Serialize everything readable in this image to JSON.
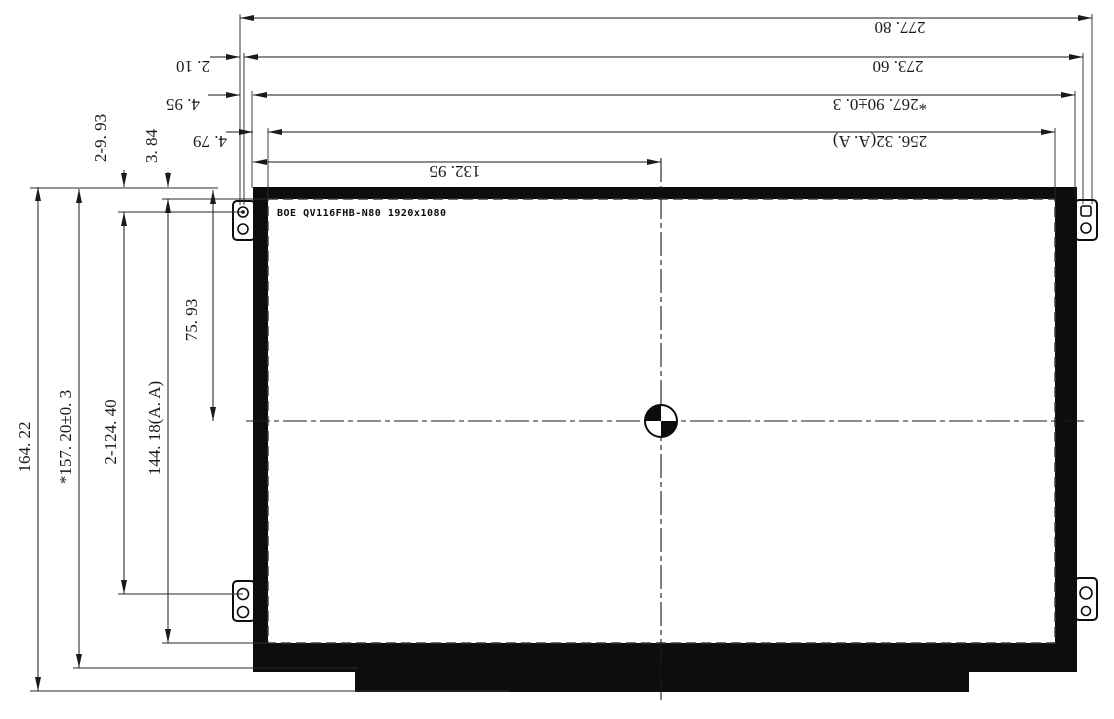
{
  "drawing": {
    "panel_label": "BOE QV116FHB-N80 1920x1080",
    "dims_horizontal": {
      "overall": "277. 80",
      "mounting": "273. 60",
      "side_gap": "2. 10",
      "outline": "*267. 90±0. 3",
      "edge_left": "4. 95",
      "active_area": "256. 32(A. A)",
      "aa_edge_left": "4. 79",
      "half_width": "132. 95"
    },
    "dims_vertical": {
      "overall": "164. 22",
      "outline": "*157. 20±0. 3",
      "hole_pitch": "2-124. 40",
      "active_area": "144. 18(A. A)",
      "half_height": "75. 93",
      "hole_offset": "2-9. 93",
      "edge_top": "3. 84"
    },
    "colors": {
      "line": "#1a1a1a",
      "fill": "#0d0d0d",
      "background": "#ffffff"
    }
  }
}
